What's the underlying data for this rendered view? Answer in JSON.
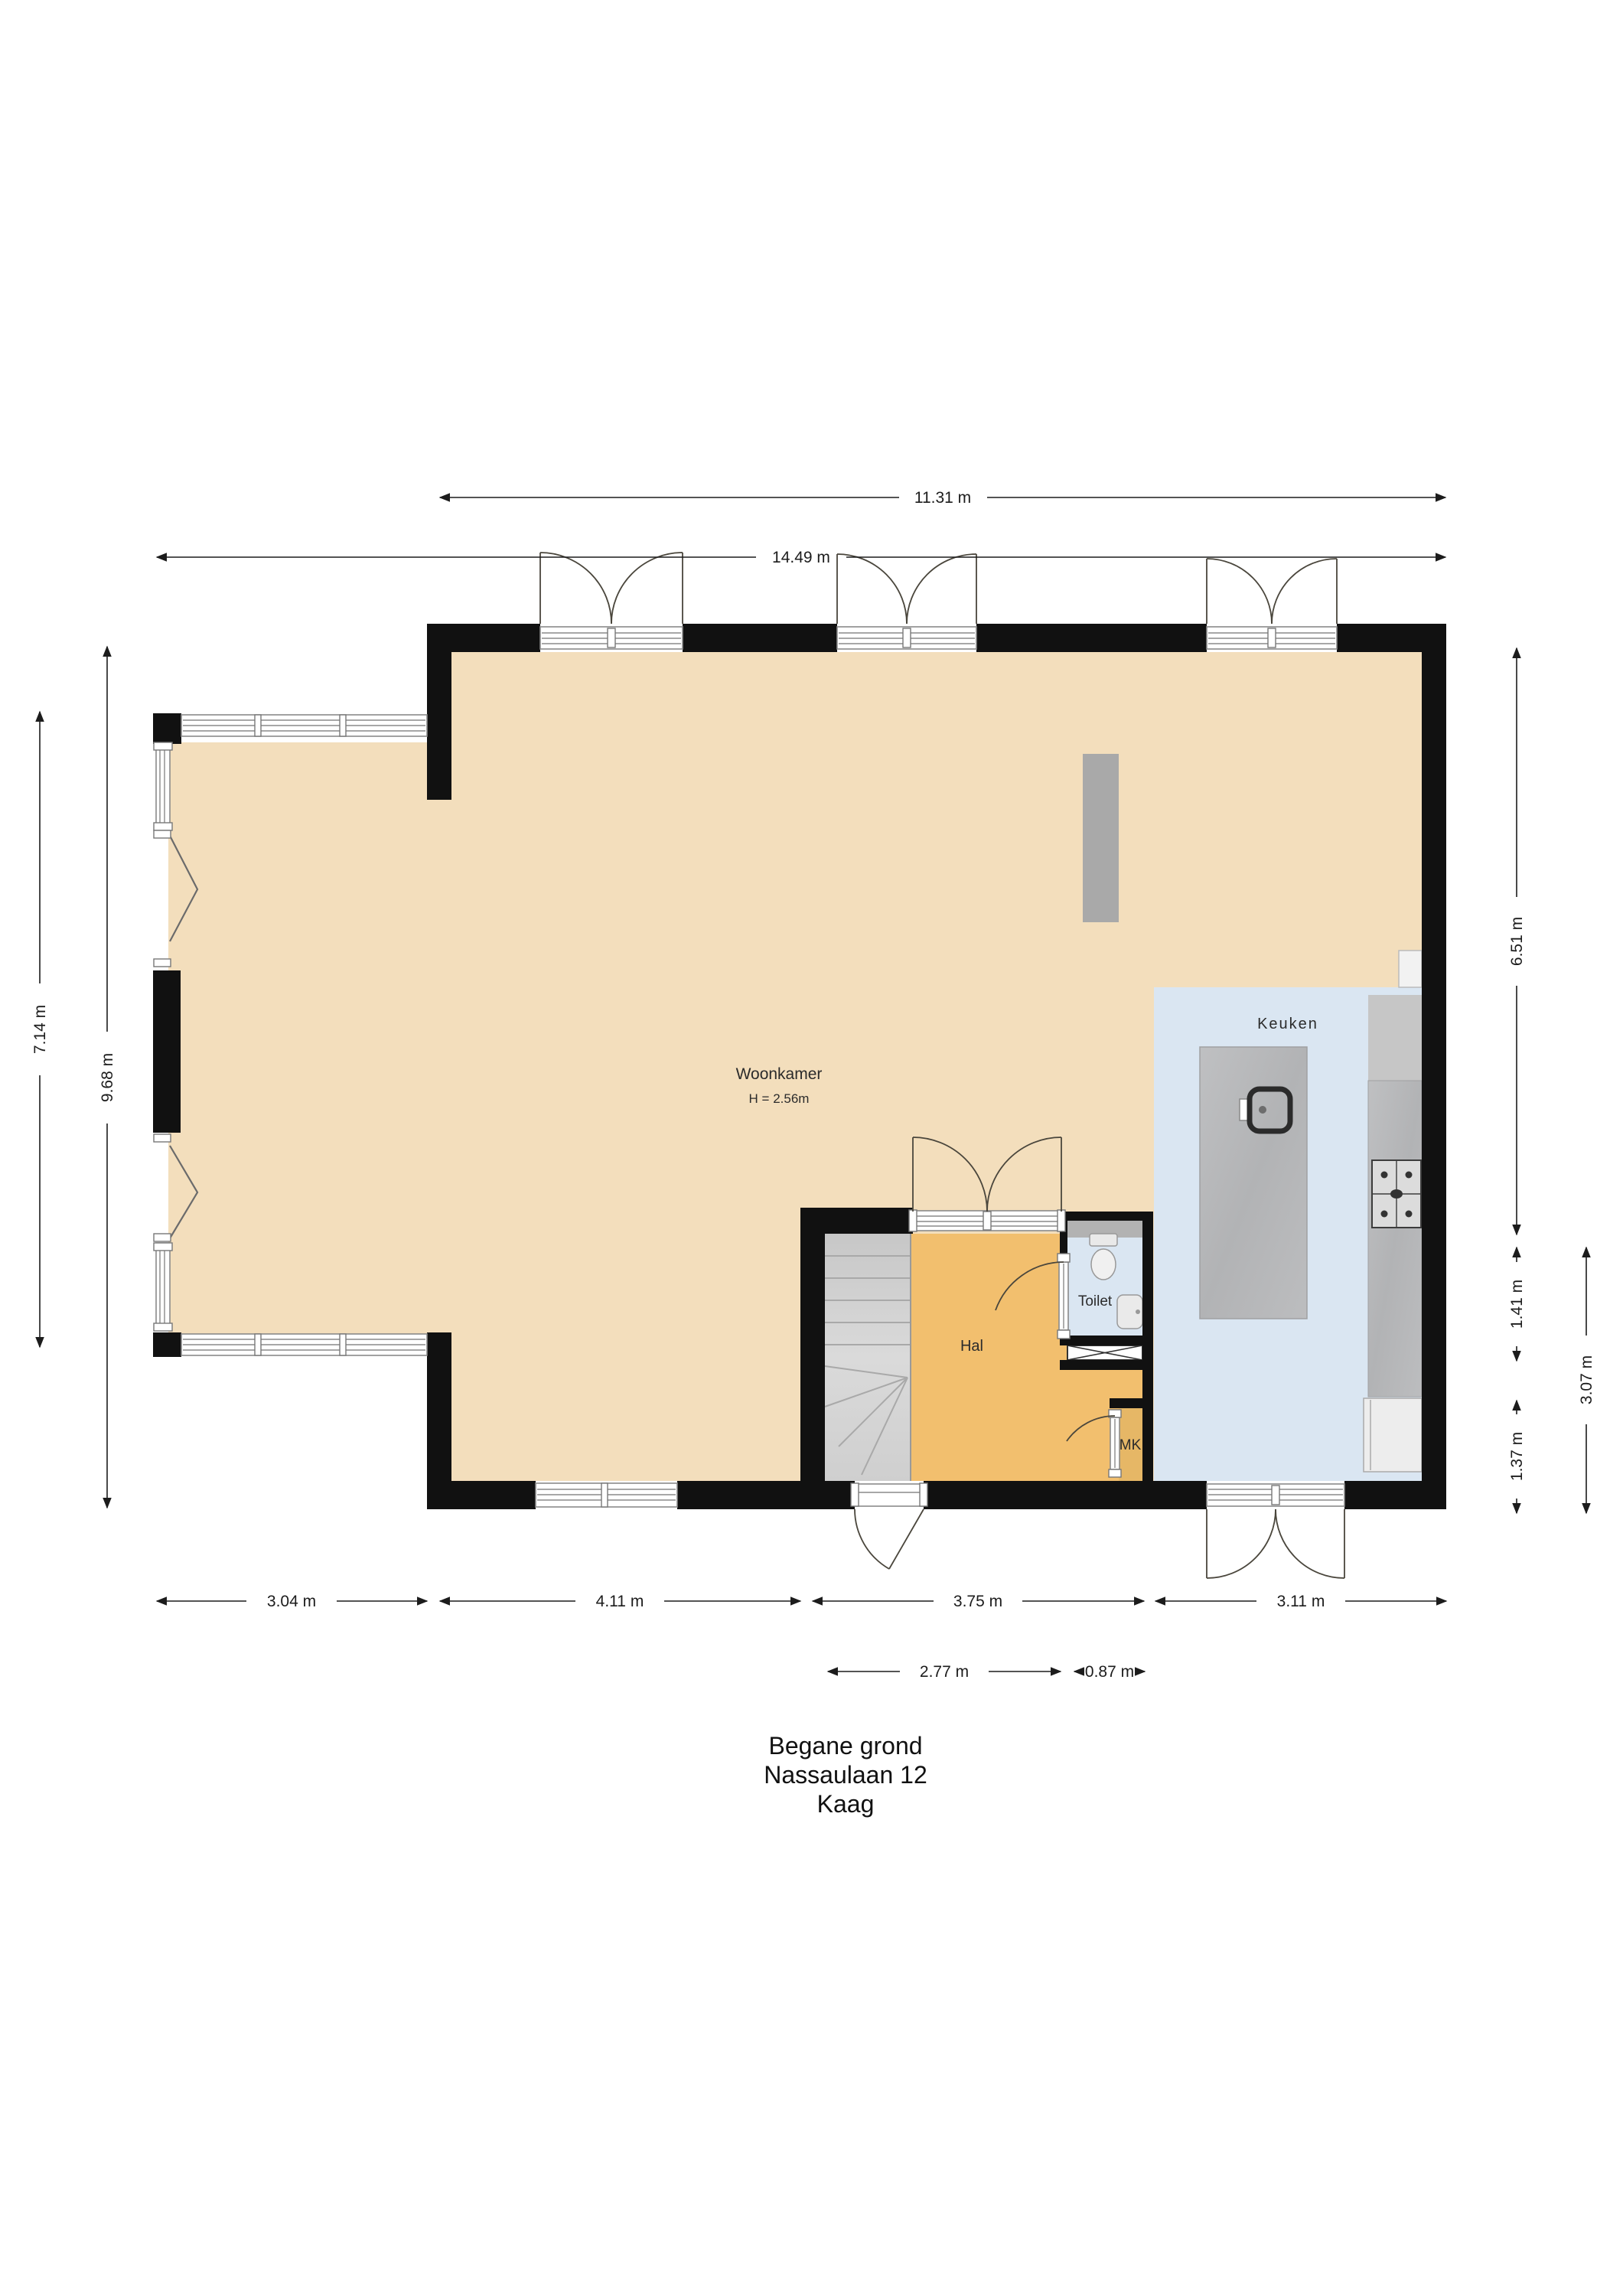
{
  "title": {
    "floor": "Begane grond",
    "street": "Nassaulaan 12",
    "city": "Kaag"
  },
  "rooms": {
    "woonkamer": "Woonkamer",
    "woonkamer_height": "H = 2.56m",
    "keuken": "Keuken",
    "hal": "Hal",
    "toilet": "Toilet",
    "mk": "MK"
  },
  "dims": {
    "top_inner": "11.31 m",
    "top_outer": "14.49 m",
    "left_outer": "7.14 m",
    "left_inner": "9.68 m",
    "right_upper": "6.51 m",
    "right_mid": "1.41 m",
    "right_lower": "1.37 m",
    "right_outer": "3.07 m",
    "bottom_1": "3.04 m",
    "bottom_2": "4.11 m",
    "bottom_3": "3.75 m",
    "bottom_4": "3.11 m",
    "bottom_hal": "2.77 m",
    "bottom_toilet": "0.87 m"
  },
  "colors": {
    "wall": "#111111",
    "woonkamer_floor": "#f3debc",
    "hal_floor": "#f2bf6e",
    "kitchen_floor": "#dae6f2",
    "mk_floor": "#e6b766",
    "stairs": "#d3d3d3",
    "counter_marble": "#b5b6b8",
    "counter_upper": "#c6c6c6",
    "chimney_gray": "#a9a9a9"
  }
}
